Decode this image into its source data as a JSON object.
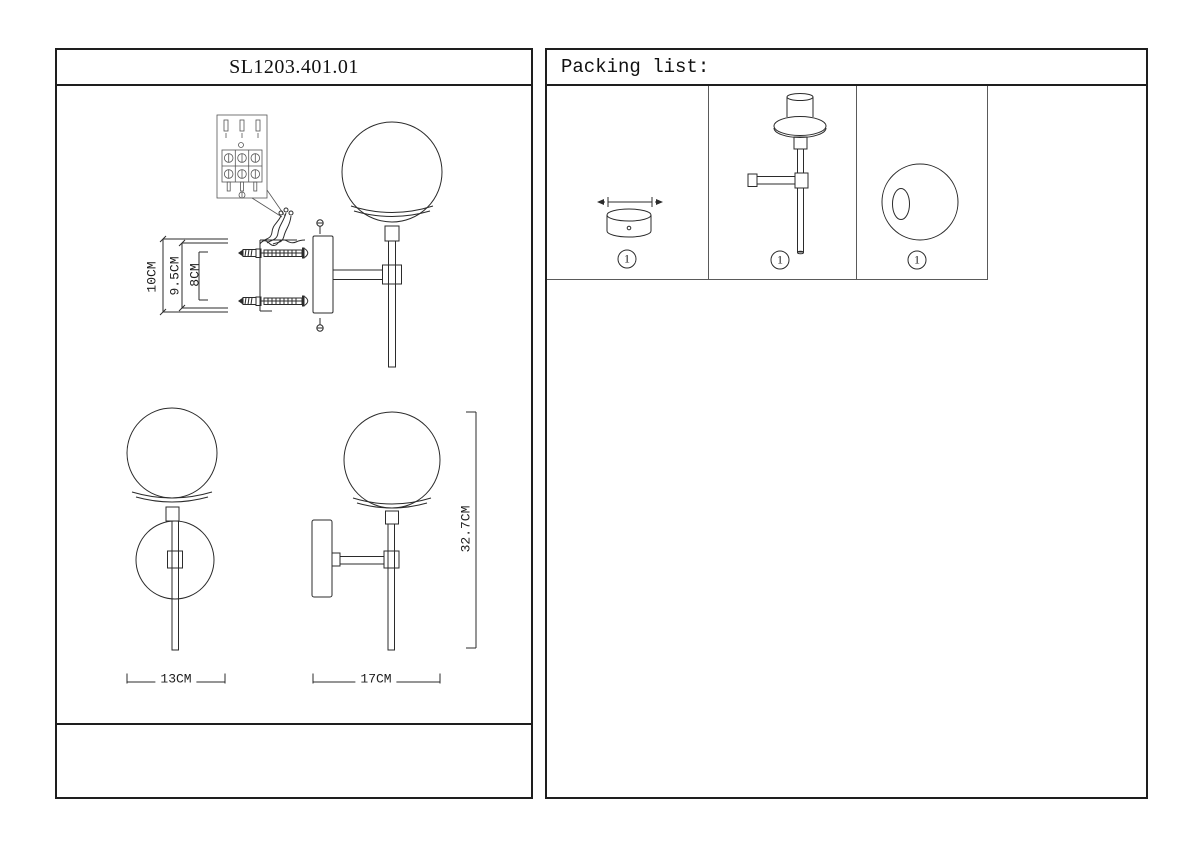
{
  "left_panel": {
    "title": "SL1203.401.01",
    "installation_dims": {
      "outer": "10CM",
      "middle": "9.5CM",
      "inner": "8CM"
    },
    "product_dims": {
      "front_width": "13CM",
      "side_depth": "17CM",
      "height": "32.7CM"
    }
  },
  "right_panel": {
    "title": "Packing list:",
    "items": [
      {
        "name": "mounting-canopy",
        "qty": "1"
      },
      {
        "name": "lamp-body-with-arm",
        "qty": "1"
      },
      {
        "name": "glass-globe-shade",
        "qty": "1"
      }
    ]
  },
  "colors": {
    "line": "#2b2b2b",
    "panel_border": "#1e1e1e"
  }
}
